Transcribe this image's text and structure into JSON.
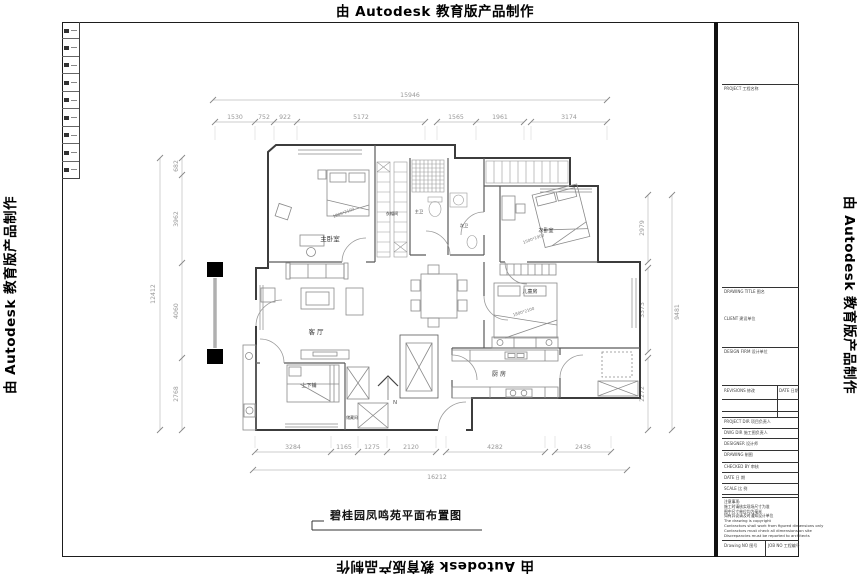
{
  "watermark": {
    "text": "由 Autodesk 教育版产品制作"
  },
  "drawing_title": {
    "text": "碧桂园凤鸣苑平面布置图"
  },
  "north_label": "N",
  "rooms": {
    "master_bedroom": "主卧室",
    "cloakroom": "衣帽间",
    "master_bath": "主卫",
    "second_bath": "次卫",
    "second_bedroom": "次卧室",
    "kids_room": "儿童房",
    "living_room": "客 厅",
    "kitchen": "厨 房",
    "bunk_room": "上下铺",
    "storage": "储藏间"
  },
  "furniture_labels": {
    "master_bed_size": "1800*2100",
    "second_bed_size": "1500*1900",
    "kids_bed_size": "1800*2100"
  },
  "dimensions": {
    "top": {
      "total": "15946",
      "segments": [
        "1530",
        "752",
        "922",
        "5172",
        "1565",
        "1961",
        "3174"
      ]
    },
    "bottom": {
      "total": "16212",
      "segments": [
        "3284",
        "1165",
        "1275",
        "2120",
        "4282",
        "2436"
      ]
    },
    "left": {
      "total": "12412",
      "segments": [
        "682",
        "3962",
        "4060",
        "2768"
      ]
    },
    "right": {
      "total": "9481",
      "segments": [
        "2979",
        "3373",
        "2272"
      ]
    }
  },
  "titleblock": {
    "project": "PROJECT 工程名称",
    "drawing_title_label": "DRAWING TITLE 图名",
    "client": "CLIENT 建设单位",
    "design_firm": "DESIGN FIRM 设计单位",
    "revisions": "REVISIONS 修改",
    "date_col": "DATE 日期",
    "project_dir": "PROJECT DIR 项目负责人",
    "cd_dir": "DWG DIR 施工图负责人",
    "designer": "DESIGNER 设计师",
    "drawing": "DRAWING 制图",
    "checked": "CHECKED BY 审核",
    "date": "DATE 日 期",
    "scale": "SCALE 比 例",
    "notes": [
      "注意事项:",
      "施工时请核实现场尺寸为准",
      "图中尺寸单位均为毫米",
      "如有异议请及时通知设计单位",
      "The drawing is copyright",
      "Contractors shall work from figured dimensions only",
      "Contractors must check all dimensions on site",
      "Discrepancies must be reported to architects"
    ],
    "drawing_no": "Drawing NO 图号",
    "job_no": "JOB NO 工程编号"
  }
}
